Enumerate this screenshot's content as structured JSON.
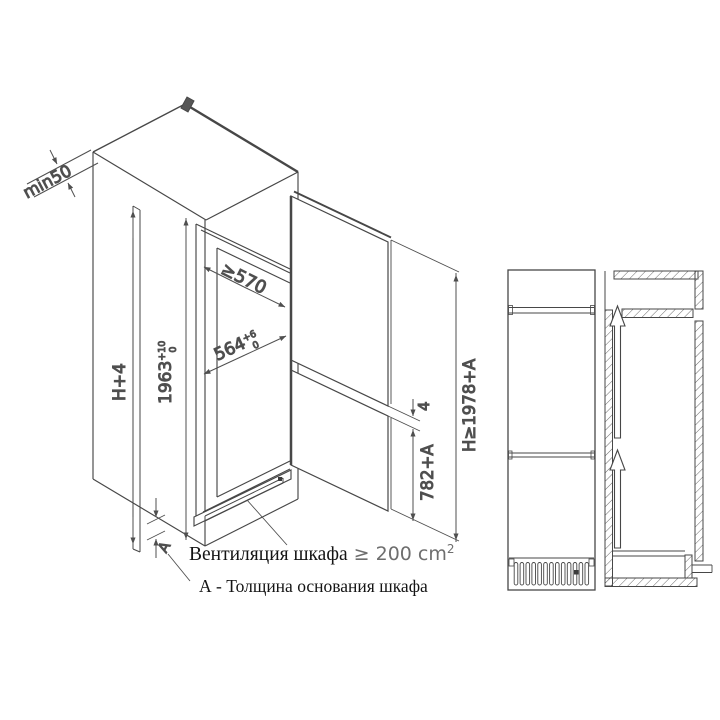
{
  "colors": {
    "line": "#474747",
    "dim_text": "#4f4f4f",
    "note_gray": "#6e6e6e",
    "text": "#141414",
    "background": "#ffffff"
  },
  "iso": {
    "min_back_clearance": "min50",
    "depth": "≥570",
    "width": {
      "value": "564",
      "tol_upper": "+6",
      "tol_lower": "0"
    },
    "niche_height": {
      "value": "1963",
      "tol_upper": "+10",
      "tol_lower": "0"
    },
    "height_h4": "H+4",
    "door_gap": "4",
    "lower_door_height": "782+A",
    "total_height": "H≥1978+A",
    "base_thickness": "A"
  },
  "notes": {
    "ventilation_label": "Вентиляция шкафа",
    "ventilation_value": " ≥ 200 cm",
    "ventilation_sup": "2",
    "base_note": "А - Толщина основания шкафа"
  }
}
